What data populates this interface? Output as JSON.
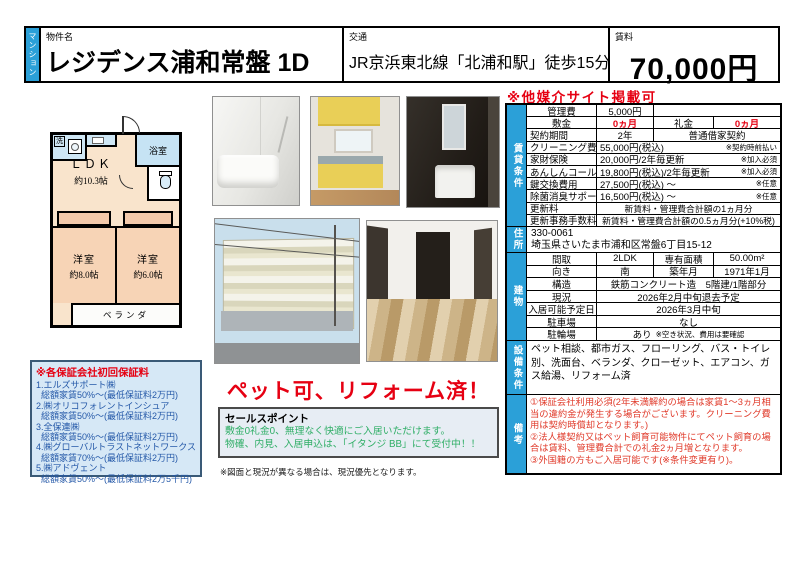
{
  "header": {
    "category_tag": "マンション",
    "property_label": "物件名",
    "property_name": "レジデンス浦和常盤 1D",
    "transport_label": "交通",
    "transport": "JR京浜東北線「北浦和駅」徒歩15分",
    "rent_label": "賃料",
    "rent": "70,000円"
  },
  "site_note": "※他媒介サイト掲載可",
  "rental": {
    "section_label": "賃貸条件",
    "rows": [
      {
        "label": "管理費",
        "value": "5,000円"
      },
      {
        "label": "敷金",
        "value": "0ヵ月",
        "label2": "礼金",
        "value2": "0ヵ月"
      },
      {
        "label": "契約期間",
        "value": "2年",
        "value2": "普通借家契約"
      },
      {
        "label": "クリーニング費用",
        "value": "55,000円(税込)",
        "note": "※契約時前払い"
      },
      {
        "label": "家財保険",
        "value": "20,000円/2年毎更新",
        "note": "※加入必須"
      },
      {
        "label": "あんしんコール24",
        "value": "19,800円(税込)/2年毎更新",
        "note": "※加入必須"
      },
      {
        "label": "鍵交換費用",
        "value": "27,500円(税込) ～",
        "note": "※任意"
      },
      {
        "label": "除菌消臭サポート",
        "value": "16,500円(税込) ～",
        "note": "※任意"
      },
      {
        "label": "更新料",
        "value": "新賃料・管理費合計額の1ヵ月分"
      },
      {
        "label": "更新事務手数料",
        "value": "新賃料・管理費合計額の0.5ヵ月分(+10%税)"
      }
    ]
  },
  "address": {
    "section_label": "住所",
    "postal": "330-0061",
    "text": "埼玉県さいたま市浦和区常盤6丁目15-12"
  },
  "building": {
    "section_label": "建物",
    "rows": [
      {
        "label": "間取",
        "value": "2LDK",
        "label2": "専有面積",
        "value2": "50.00m²"
      },
      {
        "label": "向き",
        "value": "南",
        "label2": "築年月",
        "value2": "1971年1月"
      },
      {
        "label": "構造",
        "value": "鉄筋コンクリート造　5階建/1階部分"
      },
      {
        "label": "現況",
        "value": "2026年2月中旬退去予定"
      },
      {
        "label": "入居可能予定日",
        "value": "2026年3月中旬"
      },
      {
        "label": "駐車場",
        "value": "なし"
      },
      {
        "label": "駐輪場",
        "value": "あり",
        "note": "※空き状況、費用は要確認"
      }
    ]
  },
  "equipment": {
    "section_label": "設備条件",
    "text": "ペット相談、都市ガス、フローリング、バス・トイレ別、洗面台、ベランダ、クローゼット、エアコン、ガス給湯、リフォーム済"
  },
  "remarks": {
    "section_label": "備考",
    "lines": [
      "①保証会社利用必須(2年未満解約の場合は家賃1～3ヵ月相当の違約金が発生する場合がございます。クリーニング費用は契約時償却となります。)",
      "②法人様契約又はペット飼育可能物件にてペット飼育の場合は賃料、管理費合計での礼金2ヵ月増となります。",
      "③外国籍の方もご入居可能です(※条件変更有り)。"
    ]
  },
  "floorplan": {
    "wash": "洗",
    "bath": "浴室",
    "ldk": "ＬＤＫ",
    "ldk_size": "約10.3帖",
    "room1": "洋室",
    "room1_size": "約8.0帖",
    "room2": "洋室",
    "room2_size": "約6.0帖",
    "balcony": "ベランダ"
  },
  "pet_note": "ペット可、リフォーム済！",
  "sales": {
    "title": "セールスポイント",
    "lines": [
      "敷金0礼金0、無理なく快適にご入居いただけます。",
      "物確、内見、入居申込は、「イタンジ BB」にて受付中！！"
    ]
  },
  "disclaimer": "※図面と現況が異なる場合は、現況優先となります。",
  "guarantee": {
    "title": "※各保証会社初回保証料",
    "items": [
      {
        "name": "1.エルズサポート㈱",
        "detail": "総額家賃50%～(最低保証料2万円)"
      },
      {
        "name": "2.㈱オリコフォレントインシュア",
        "detail": "総額家賃50%～(最低保証料2万円)"
      },
      {
        "name": "3.全保連㈱",
        "detail": "総額家賃50%～(最低保証料2万円)"
      },
      {
        "name": "4.㈱グローバルトラストネットワークス",
        "detail": "総額家賃70%～(最低保証料2万円)"
      },
      {
        "name": "5.㈱アドヴェント",
        "detail": "総額家賃50%～(最低保証料2万5千円)"
      }
    ]
  },
  "colors": {
    "accent_blue": "#2BA0D8",
    "alert_red": "#E60012",
    "remarks_red": "#E03A2A",
    "guarantee_text_blue": "#2458A8",
    "guarantee_bg": "#D6E8F6",
    "sales_green": "#2FAE66",
    "floorplan_room_peach": "#F7D4B6",
    "floorplan_bath_blue": "#C6E3F4"
  }
}
